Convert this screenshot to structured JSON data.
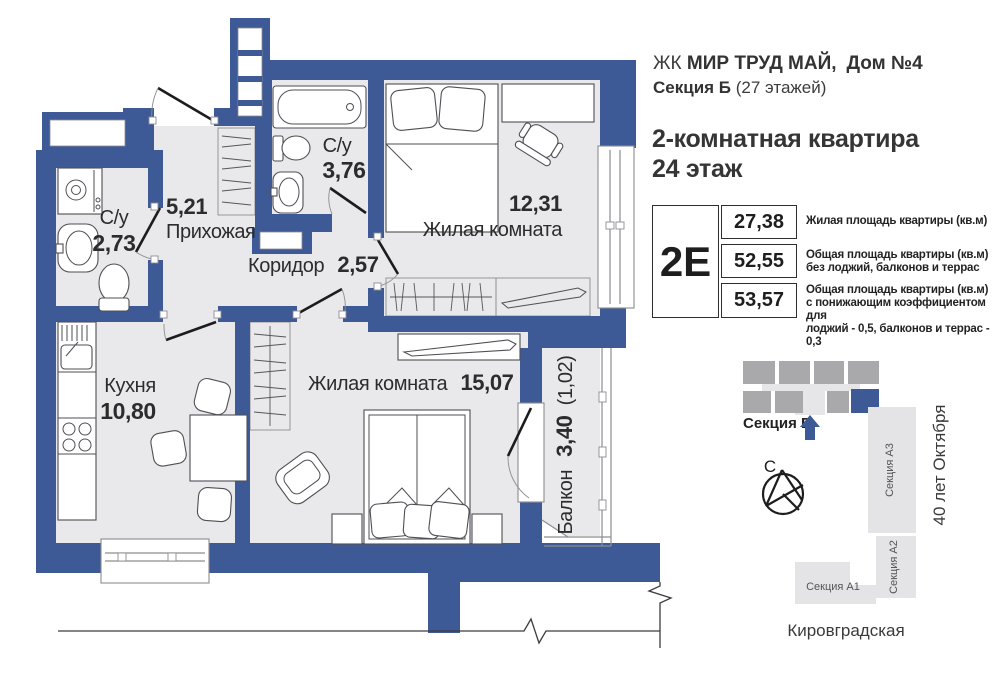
{
  "colors": {
    "wall_blue": "#3d5a96",
    "floor_grey": "#e9e9ec",
    "site_grey": "#a9a9ab",
    "site_light": "#e6e6e8",
    "text_dark": "#2c2c2c"
  },
  "header": {
    "complex_prefix": "ЖК",
    "complex_bold": "МИР ТРУД МАЙ,",
    "house_bold": "Дом №4",
    "section_bold": "Секция Б",
    "section_floors": "(27 этажей)",
    "apartment_title": "2-комнатная квартира",
    "floor_title": "24 этаж"
  },
  "info_table": {
    "apartment_type": "2Е",
    "rows": [
      {
        "value": "27,38",
        "desc_lines": [
          "Жилая площадь квартиры (кв.м)"
        ]
      },
      {
        "value": "52,55",
        "desc_lines": [
          "Общая площадь квартиры (кв.м)",
          "без лоджий, балконов и террас"
        ]
      },
      {
        "value": "53,57",
        "desc_lines": [
          "Общая площадь квартиры (кв.м)",
          "с понижающим коэффициентом для",
          "лоджий - 0,5, балконов и террас - 0,3"
        ]
      }
    ]
  },
  "floor_plan": {
    "rooms": {
      "bathroom_small": {
        "name": "С/у",
        "area": "2,73"
      },
      "hallway": {
        "name": "Прихожая",
        "area": "5,21"
      },
      "bathroom_large": {
        "name": "С/у",
        "area": "3,76"
      },
      "bedroom": {
        "name": "Жилая комната",
        "area": "12,31"
      },
      "corridor": {
        "name": "Коридор",
        "area": "2,57"
      },
      "kitchen": {
        "name": "Кухня",
        "area": "10,80"
      },
      "living_room": {
        "name": "Жилая комната",
        "area": "15,07"
      },
      "balcony": {
        "name": "Балкон",
        "area": "3,40",
        "area_reduced": "(1,02)"
      }
    }
  },
  "site_plan": {
    "current_section_label": "Секция Б",
    "north_label": "С",
    "sections": [
      "Секция А3",
      "Секция А2",
      "Секция А1"
    ],
    "street_right": "40 лет Октября",
    "street_bottom": "Кировградская"
  }
}
